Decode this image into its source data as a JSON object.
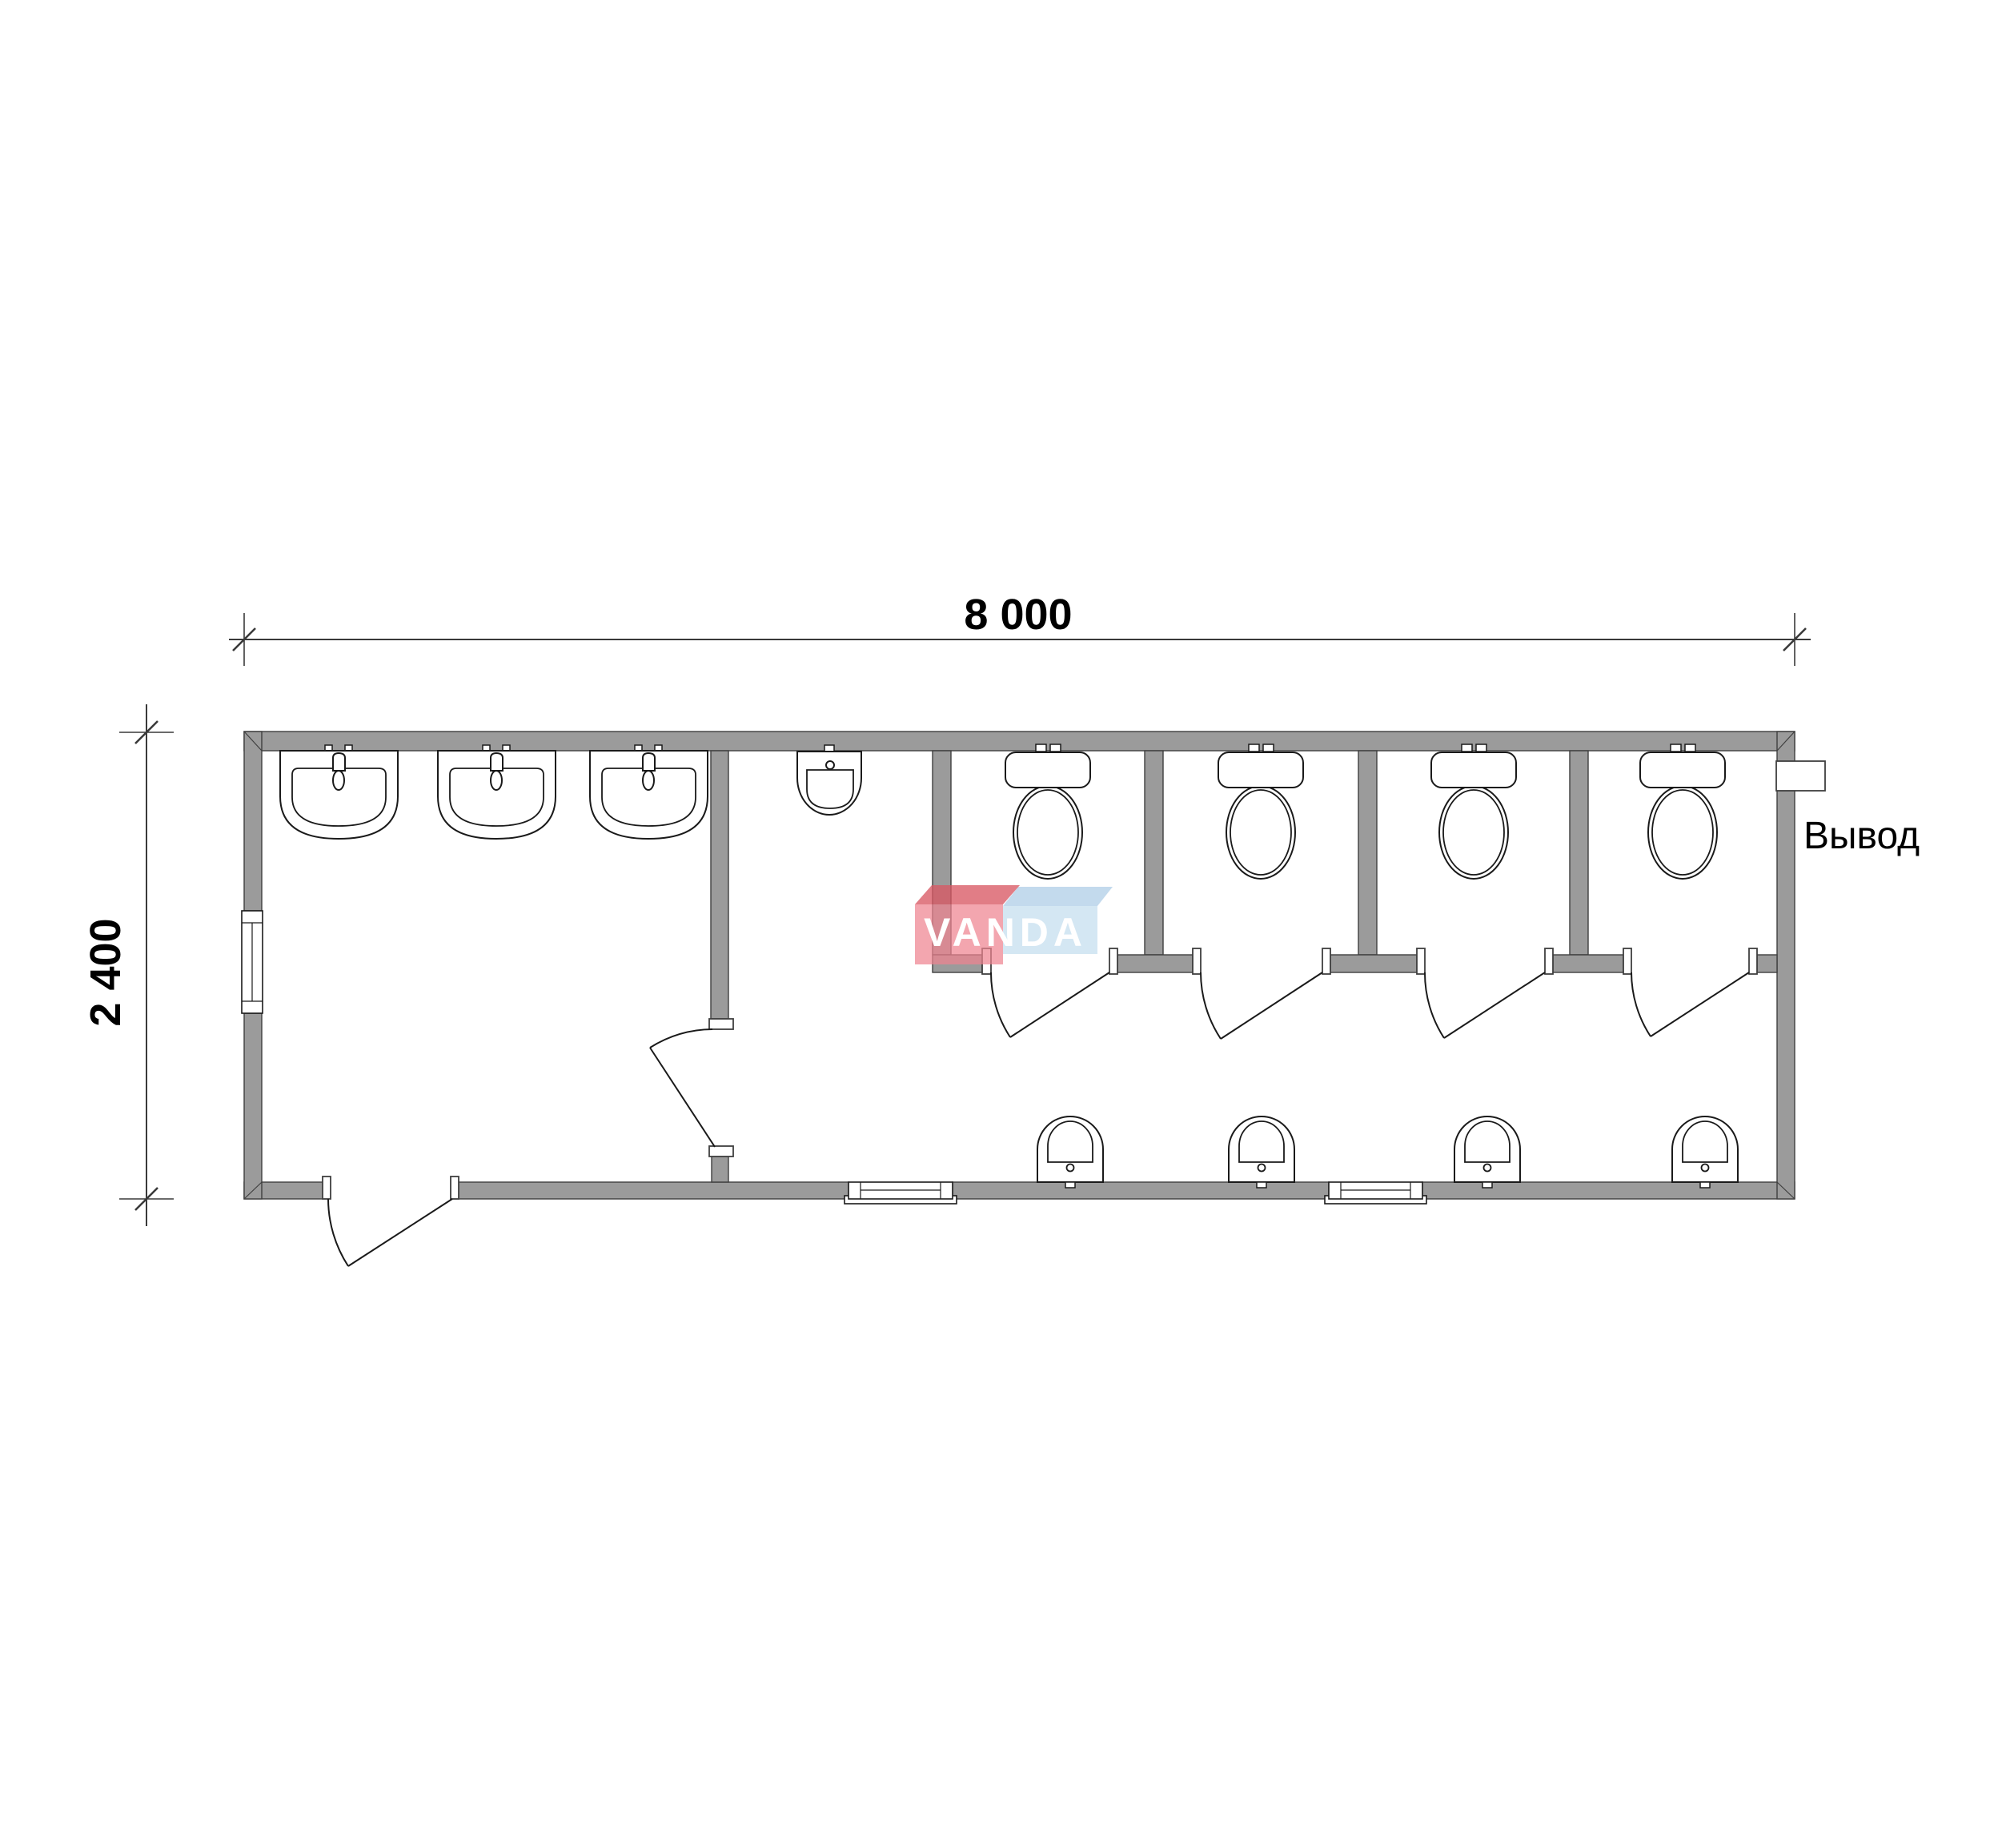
{
  "page": {
    "type": "architectural floor plan",
    "subject": "modular sanitary block / toilet container, plan view",
    "background": "#ffffff"
  },
  "dimensions": {
    "width": {
      "label": "8 000"
    },
    "height": {
      "label": "2 400"
    }
  },
  "labels": {
    "outlet": "Вывод"
  },
  "watermark": {
    "text": "VANDA"
  },
  "colors": {
    "bg": "#ffffff",
    "wall": "#9b9b9b",
    "wall-line": "#3f3f3f",
    "fx-line": "#1a1a1a",
    "dim-line": "#3a3a3a",
    "text": "#000000",
    "wm-red": "#ee8490",
    "wm-red-top": "#d85864",
    "wm-blue": "#bad8ec",
    "wm-blue-top": "#9ec4e2",
    "wm-text": "#ffffff"
  },
  "fixtures": {
    "washbasins": 3,
    "wall_hung_urinal": 1,
    "toilets": 4,
    "toilet_stalls": 4,
    "floor_urinals": 4,
    "windows": 3,
    "doors": 6,
    "sewer_outlet": 1
  }
}
